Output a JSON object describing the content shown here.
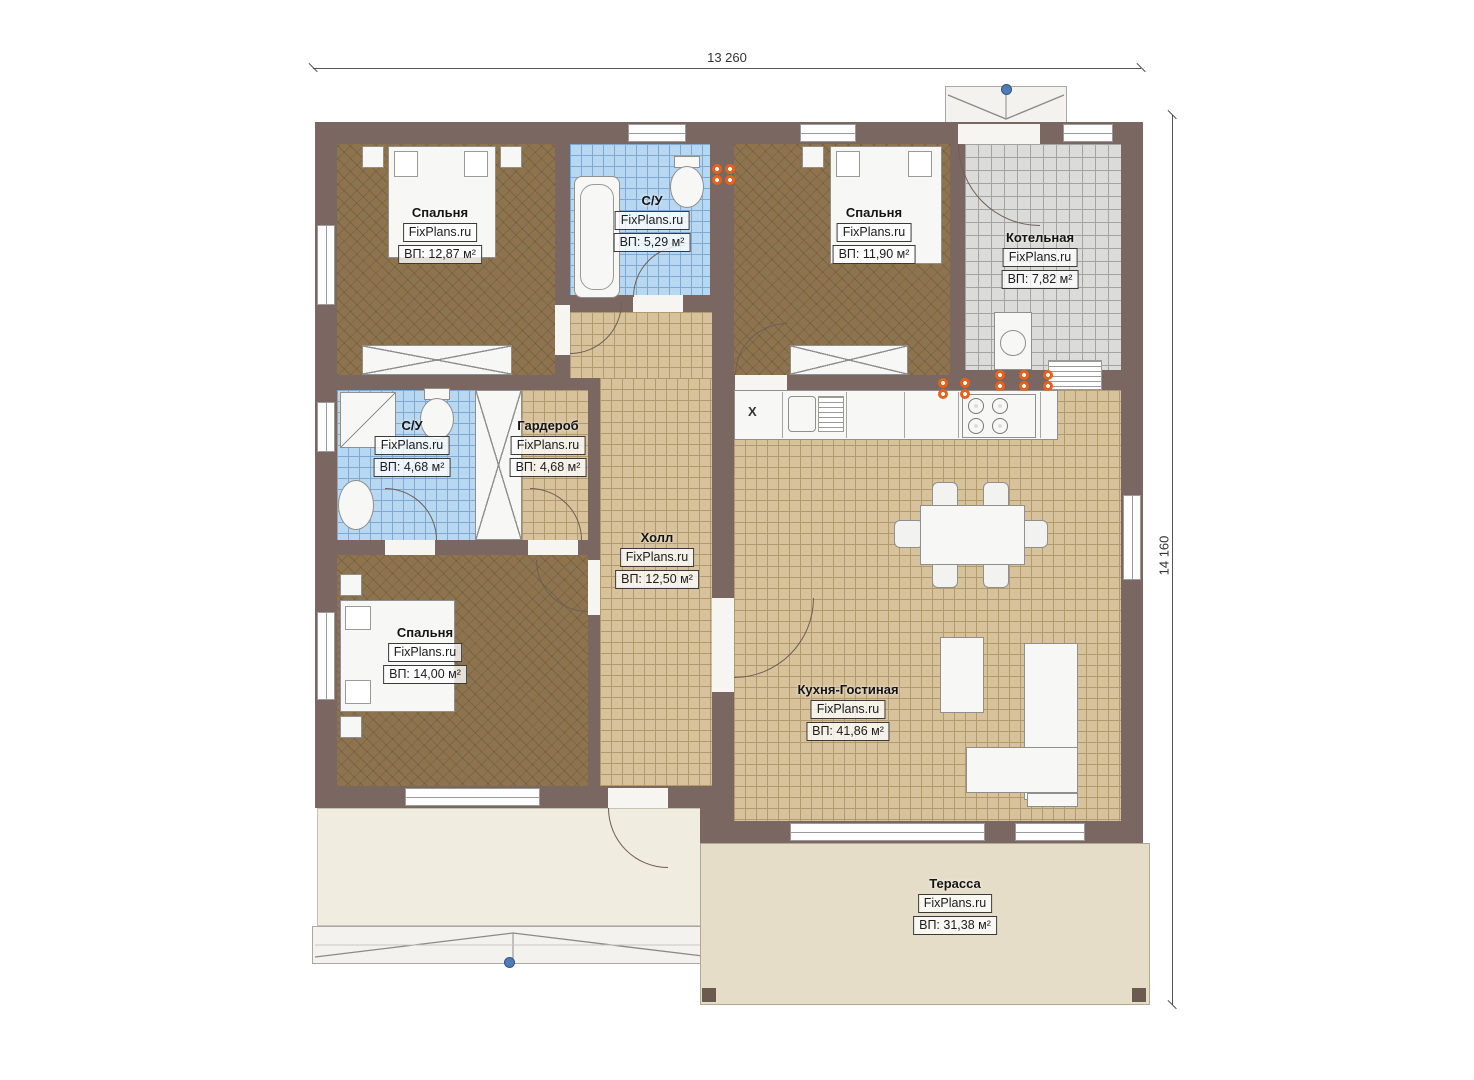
{
  "watermark": "FixPlans.ru",
  "dimensions": {
    "width_label": "13 260",
    "height_label": "14 160"
  },
  "rooms": [
    {
      "id": "bedroom-top-left",
      "name": "Спальня",
      "area": "ВП: 12,87 м²"
    },
    {
      "id": "bathroom-top",
      "name": "С/У",
      "area": "ВП: 5,29 м²"
    },
    {
      "id": "bedroom-top-right",
      "name": "Спальня",
      "area": "ВП: 11,90 м²"
    },
    {
      "id": "boiler-room",
      "name": "Котельная",
      "area": "ВП: 7,82 м²"
    },
    {
      "id": "bathroom-left",
      "name": "С/У",
      "area": "ВП: 4,68 м²"
    },
    {
      "id": "wardrobe",
      "name": "Гардероб",
      "area": "ВП: 4,68 м²"
    },
    {
      "id": "hall",
      "name": "Холл",
      "area": "ВП: 12,50 м²"
    },
    {
      "id": "bedroom-bottom",
      "name": "Спальня",
      "area": "ВП: 14,00 м²"
    },
    {
      "id": "kitchen-living",
      "name": "Кухня-Гостиная",
      "area": "ВП: 41,86 м²"
    },
    {
      "id": "terrace",
      "name": "Терасса",
      "area": "ВП: 31,38 м²"
    }
  ],
  "kitchen": {
    "corner_mark": "X"
  },
  "colors": {
    "wall": "#7a6762",
    "bedroom_floor": "#8d744f",
    "tile_tan": "#d7c29b",
    "tile_blue": "#b8d8f2",
    "tile_gray": "#dbdbd9",
    "terrace": "#e6ddc8",
    "socket_accent": "#e8611a",
    "marker_blue": "#4f7cb4"
  }
}
